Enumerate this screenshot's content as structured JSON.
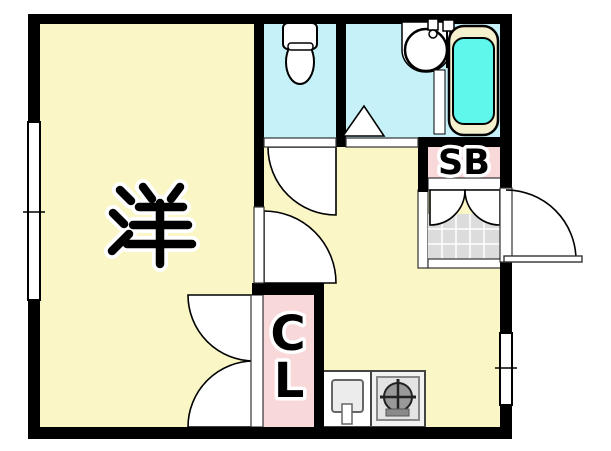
{
  "plan": {
    "labels": {
      "main_room": "洋",
      "closet_line1": "C",
      "closet_line2": "L",
      "shoe_box": "SB"
    },
    "colors": {
      "room_yellow": "#FAF6C5",
      "wet_cyan": "#C6F1F8",
      "tub_water": "#5FF6EC",
      "tub_rim": "#F5F0CE",
      "accent_pink": "#F9D8DA",
      "tile_gray": "#DCDCDC",
      "wall_black": "#000000"
    },
    "fixtures": [
      "toilet-icon",
      "wash-basin-icon",
      "bathtub-icon",
      "kitchen-sink-icon",
      "gas-stove-icon",
      "entrance-door-icon",
      "window-icon",
      "closet-double-door-icon",
      "shoebox-double-door-icon"
    ]
  }
}
